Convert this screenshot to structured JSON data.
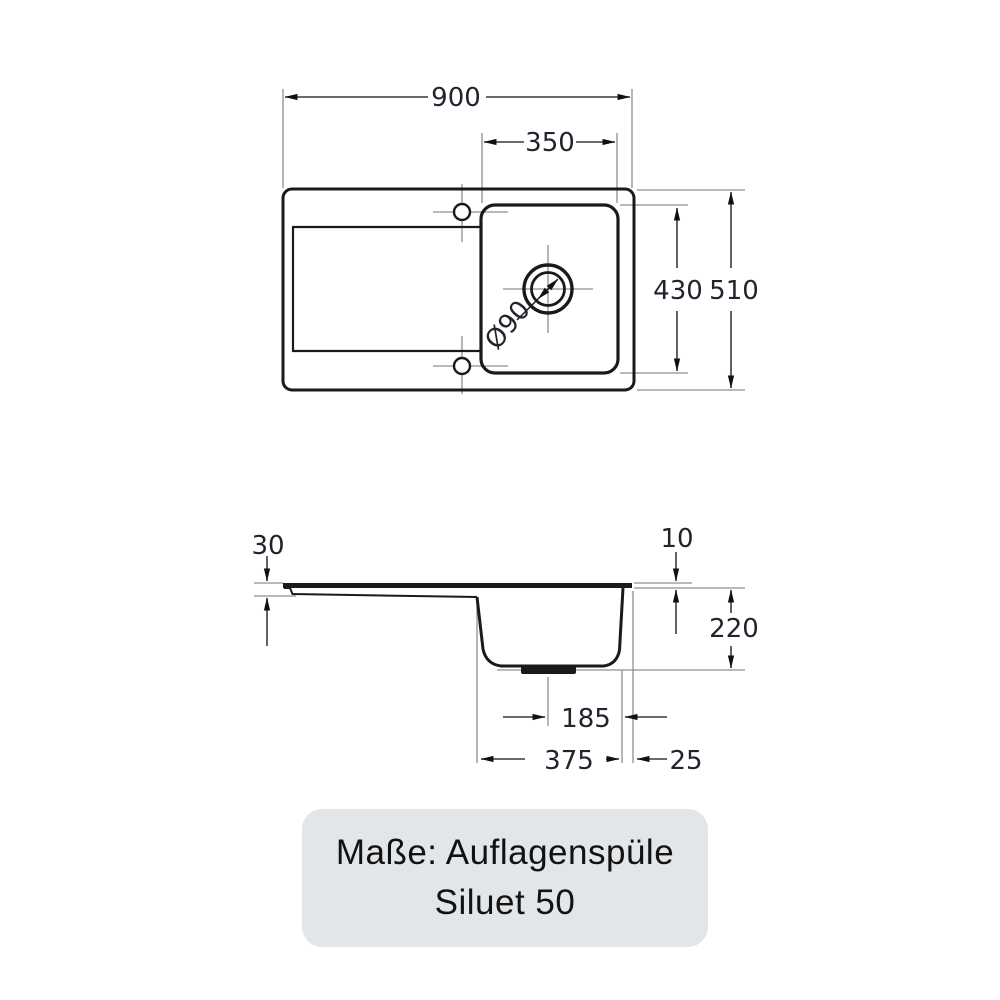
{
  "drawing_title": "Sink dimension drawing",
  "colors": {
    "outline": "#1a1a1a",
    "dimension_line": "#3a3a3a",
    "extension_line": "#8f8f8f",
    "dimension_text": "#20242c",
    "caption_background": "#e3e6e9",
    "caption_text": "#121212"
  },
  "top_view": {
    "overall_width": "900",
    "bowl_width": "350",
    "bowl_length": "430",
    "overall_depth": "510",
    "drain_diameter": "Ø90"
  },
  "side_view": {
    "front_edge_height": "30",
    "rim_thickness": "10",
    "bowl_depth": "220",
    "drain_offset": "185",
    "bowl_base_width": "375",
    "edge_offset": "25"
  },
  "caption": {
    "line1": "Maße: Auflagenspüle",
    "line2": "Siluet 50"
  }
}
